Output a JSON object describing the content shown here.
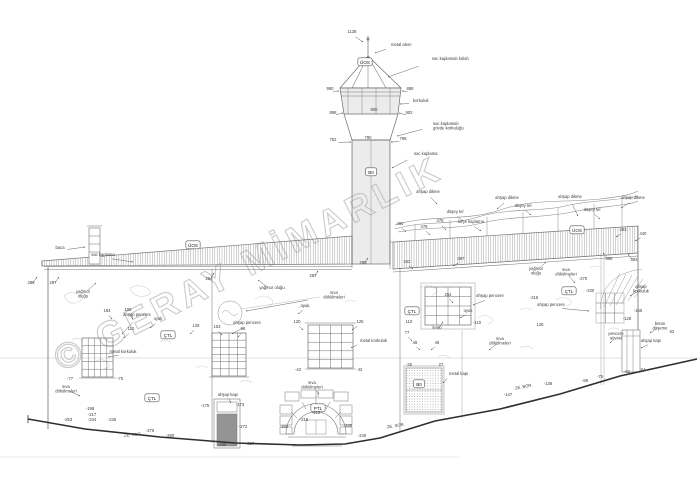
{
  "meta": {
    "watermark": "© GERAY MİMARLIK"
  },
  "colors": {
    "line": "#6e6e6e",
    "ground": "#2e2e2e",
    "watermark": "#cacaca",
    "roof_hatch": "#9d9d9d",
    "balcony_fill": "#ececec",
    "annotation_text": "#3c3c3c"
  },
  "drawing": {
    "tags": [
      {
        "x": 365,
        "y": 62,
        "t": "ÜOS"
      },
      {
        "x": 193,
        "y": 245,
        "t": "ÜOS"
      },
      {
        "x": 577,
        "y": 230,
        "t": "ÜOS"
      },
      {
        "x": 371,
        "y": 172,
        "t": "B0"
      },
      {
        "x": 419,
        "y": 384,
        "t": "B0"
      },
      {
        "x": 168,
        "y": 335,
        "t": "ÇTL"
      },
      {
        "x": 412,
        "y": 311,
        "t": "ÇTL"
      },
      {
        "x": 569,
        "y": 291,
        "t": "ÇTL"
      },
      {
        "x": 152,
        "y": 398,
        "t": "ÇTL"
      },
      {
        "x": 318,
        "y": 408,
        "t": "PTL"
      }
    ],
    "annotations": [
      {
        "x": 352,
        "y": 33,
        "t": "1138",
        "ax": 363,
        "ay": 42
      },
      {
        "x": 391,
        "y": 46,
        "t": "metal alem",
        "an": "start",
        "ax": 375,
        "ay": 53
      },
      {
        "x": 432,
        "y": 60,
        "t": "sac kaplamalı külah",
        "an": "start",
        "ax": 388,
        "ay": 77
      },
      {
        "x": 330,
        "y": 90,
        "t": "980",
        "ax": 339,
        "ay": 91
      },
      {
        "x": 410,
        "y": 90,
        "t": "888",
        "ax": 402,
        "ay": 91
      },
      {
        "x": 413,
        "y": 102,
        "t": "korkuluk",
        "an": "start",
        "ax": 400,
        "ay": 104
      },
      {
        "x": 333,
        "y": 114,
        "t": "898",
        "ax": 343,
        "ay": 113
      },
      {
        "x": 374,
        "y": 111,
        "t": "900"
      },
      {
        "x": 409,
        "y": 114,
        "t": "902",
        "ax": 399,
        "ay": 113
      },
      {
        "x": 333,
        "y": 141,
        "t": "752",
        "ax": 351,
        "ay": 142
      },
      {
        "x": 368,
        "y": 139,
        "t": "790"
      },
      {
        "x": 403,
        "y": 140,
        "t": "798",
        "ax": 391,
        "ay": 142
      },
      {
        "x": 433,
        "y": 125,
        "t": "sac kaplamalı",
        "t2": "gövde korkuluğu",
        "an": "start",
        "ax": 397,
        "ay": 136
      },
      {
        "x": 414,
        "y": 155,
        "t": "sac kaplama",
        "an": "start",
        "ax": 392,
        "ay": 168
      },
      {
        "x": 60,
        "y": 249,
        "t": "baca",
        "ax": 85,
        "ay": 247
      },
      {
        "x": 103,
        "y": 256,
        "t": "sac kaplama",
        "ax": 133,
        "ay": 262
      },
      {
        "x": 31,
        "y": 284,
        "t": "286",
        "ax": 37,
        "ay": 277
      },
      {
        "x": 53,
        "y": 284,
        "t": "287",
        "ax": 59,
        "ay": 277
      },
      {
        "x": 428,
        "y": 193,
        "t": "ahşap dikme",
        "ax": 437,
        "ay": 204
      },
      {
        "x": 507,
        "y": 199,
        "t": "ahşap dikme",
        "ax": 497,
        "ay": 209
      },
      {
        "x": 570,
        "y": 198,
        "t": "ahşap dikme",
        "ax": 578,
        "ay": 216
      },
      {
        "x": 633,
        "y": 199,
        "t": "ahşap dikme",
        "ax": 621,
        "ay": 208
      },
      {
        "x": 455,
        "y": 213,
        "t": "düşey tel",
        "ax": 463,
        "ay": 221
      },
      {
        "x": 523,
        "y": 207,
        "t": "düşey tel",
        "ax": 531,
        "ay": 215
      },
      {
        "x": 592,
        "y": 211,
        "t": "düşey tel",
        "ax": 600,
        "ay": 219
      },
      {
        "x": 471,
        "y": 223,
        "t": "keçe kaplama",
        "ax": 481,
        "ay": 231
      },
      {
        "x": 400,
        "y": 225,
        "t": "480",
        "ax": 406,
        "ay": 232
      },
      {
        "x": 424,
        "y": 228,
        "t": "479",
        "ax": 430,
        "ay": 235
      },
      {
        "x": 440,
        "y": 222,
        "t": "475",
        "ax": 446,
        "ay": 230
      },
      {
        "x": 623,
        "y": 231,
        "t": "483",
        "ax": 616,
        "ay": 237
      },
      {
        "x": 643,
        "y": 235,
        "t": "440",
        "ax": 635,
        "ay": 241
      },
      {
        "x": 609,
        "y": 260,
        "t": "398",
        "ax": 603,
        "ay": 253
      },
      {
        "x": 634,
        "y": 261,
        "t": "392",
        "ax": 628,
        "ay": 254
      },
      {
        "x": 461,
        "y": 260,
        "t": "387",
        "ax": 453,
        "ay": 266
      },
      {
        "x": 407,
        "y": 263,
        "t": "342",
        "ax": 413,
        "ay": 269
      },
      {
        "x": 209,
        "y": 280,
        "t": "284",
        "ax": 214,
        "ay": 273
      },
      {
        "x": 313,
        "y": 277,
        "t": "287",
        "ax": 318,
        "ay": 271
      },
      {
        "x": 363,
        "y": 264,
        "t": "298",
        "ax": 368,
        "ay": 258
      },
      {
        "x": 83,
        "y": 293,
        "t": "yağmur",
        "t2": "oluğu",
        "ax": 96,
        "ay": 283
      },
      {
        "x": 137,
        "y": 316,
        "t": "ahşap pencere",
        "ax": 122,
        "ay": 334
      },
      {
        "x": 158,
        "y": 320,
        "t": "oyuk",
        "ax": 150,
        "ay": 328
      },
      {
        "x": 107,
        "y": 312,
        "t": "184",
        "ax": 112,
        "ay": 319
      },
      {
        "x": 128,
        "y": 311,
        "t": "186",
        "ax": 133,
        "ay": 319
      },
      {
        "x": 131,
        "y": 330,
        "t": "110",
        "ax": 124,
        "ay": 338
      },
      {
        "x": 196,
        "y": 327,
        "t": "128",
        "ax": 190,
        "ay": 334
      },
      {
        "x": 123,
        "y": 353,
        "t": "metal korkuluk",
        "ax": 108,
        "ay": 357
      },
      {
        "x": 66,
        "y": 388,
        "t": "sıva",
        "t2": "dökülmeleri",
        "ax": 80,
        "ay": 396
      },
      {
        "x": 70,
        "y": 380,
        "t": "-77"
      },
      {
        "x": 120,
        "y": 380,
        "t": "-75"
      },
      {
        "x": 90,
        "y": 410,
        "t": "-198"
      },
      {
        "x": 92,
        "y": 416,
        "t": "-217"
      },
      {
        "x": 92,
        "y": 421,
        "t": "-234"
      },
      {
        "x": 68,
        "y": 421,
        "t": "-253"
      },
      {
        "x": 112,
        "y": 421,
        "t": "-236"
      },
      {
        "x": 150,
        "y": 432,
        "t": "-276"
      },
      {
        "x": 170,
        "y": 437,
        "t": "-280"
      },
      {
        "x": 247,
        "y": 324,
        "t": "ahşap pencere",
        "ax": 232,
        "ay": 334
      },
      {
        "x": 217,
        "y": 328,
        "t": "153",
        "ax": 222,
        "ay": 335
      },
      {
        "x": 243,
        "y": 330,
        "t": "98",
        "ax": 238,
        "ay": 337
      },
      {
        "x": 272,
        "y": 289,
        "t": "yağmur oluğu",
        "ax": 258,
        "ay": 280
      },
      {
        "x": 334,
        "y": 294,
        "t": "sıva",
        "t2": "dökülmeleri",
        "ax": 246,
        "ay": 311
      },
      {
        "x": 305,
        "y": 307,
        "t": "oyuk",
        "ax": 298,
        "ay": 314
      },
      {
        "x": 297,
        "y": 323,
        "t": "120",
        "ax": 303,
        "ay": 330
      },
      {
        "x": 360,
        "y": 323,
        "t": "125",
        "ax": 352,
        "ay": 330
      },
      {
        "x": 360,
        "y": 342,
        "t": "metal korkuluk",
        "an": "start",
        "ax": 351,
        "ay": 348
      },
      {
        "x": 298,
        "y": 371,
        "t": "-42"
      },
      {
        "x": 360,
        "y": 371,
        "t": "42"
      },
      {
        "x": 437,
        "y": 329,
        "t": "lento",
        "ax": 443,
        "ay": 322
      },
      {
        "x": 409,
        "y": 323,
        "t": "110"
      },
      {
        "x": 477,
        "y": 324,
        "t": "-110"
      },
      {
        "x": 448,
        "y": 296,
        "t": "254",
        "ax": 453,
        "ay": 303
      },
      {
        "x": 490,
        "y": 297,
        "t": "ahşap pencere",
        "ax": 473,
        "ay": 305
      },
      {
        "x": 468,
        "y": 312,
        "t": "oyuk",
        "ax": 460,
        "ay": 318
      },
      {
        "x": 407,
        "y": 334,
        "t": "77",
        "ax": 412,
        "ay": 341
      },
      {
        "x": 415,
        "y": 344,
        "t": "48",
        "ax": 420,
        "ay": 350
      },
      {
        "x": 437,
        "y": 344,
        "t": "46",
        "ax": 431,
        "ay": 350
      },
      {
        "x": 409,
        "y": 366,
        "t": "-26"
      },
      {
        "x": 441,
        "y": 366,
        "t": "27"
      },
      {
        "x": 449,
        "y": 375,
        "t": "metal kapı",
        "an": "start",
        "ax": 443,
        "ay": 383
      },
      {
        "x": 500,
        "y": 340,
        "t": "sıva",
        "t2": "dökülmeleri",
        "ax": 489,
        "ay": 350
      },
      {
        "x": 312,
        "y": 384,
        "t": "sıva",
        "t2": "dökülmeleri",
        "ax": 319,
        "ay": 394
      },
      {
        "x": 316,
        "y": 414,
        "t": "-212"
      },
      {
        "x": 304,
        "y": 421,
        "t": "-215"
      },
      {
        "x": 284,
        "y": 428,
        "t": "-232"
      },
      {
        "x": 348,
        "y": 427,
        "t": "-235"
      },
      {
        "x": 362,
        "y": 437,
        "t": "-240"
      },
      {
        "x": 228,
        "y": 396,
        "t": "ahşap kapı",
        "ax": 231,
        "ay": 403
      },
      {
        "x": 205,
        "y": 407,
        "t": "-175"
      },
      {
        "x": 240,
        "y": 406,
        "t": "-173"
      },
      {
        "x": 222,
        "y": 446,
        "t": "-240"
      },
      {
        "x": 243,
        "y": 428,
        "t": "-272"
      },
      {
        "x": 250,
        "y": 445,
        "t": "-227"
      },
      {
        "x": 536,
        "y": 270,
        "t": "yağmur",
        "t2": "oluğu",
        "ax": 546,
        "ay": 262
      },
      {
        "x": 566,
        "y": 271,
        "t": "sıva",
        "t2": "dökülmeleri",
        "ax": 575,
        "ay": 283
      },
      {
        "x": 583,
        "y": 280,
        "t": "-270"
      },
      {
        "x": 590,
        "y": 292,
        "t": "-230"
      },
      {
        "x": 534,
        "y": 299,
        "t": "-215"
      },
      {
        "x": 551,
        "y": 306,
        "t": "ahşap pencere",
        "ax": 589,
        "ay": 311
      },
      {
        "x": 540,
        "y": 326,
        "t": "128"
      },
      {
        "x": 641,
        "y": 288,
        "t": "ahşap",
        "t2": "korkuluk",
        "ax": 630,
        "ay": 296
      },
      {
        "x": 638,
        "y": 312,
        "t": "-155"
      },
      {
        "x": 627,
        "y": 320,
        "t": "-128"
      },
      {
        "x": 660,
        "y": 325,
        "t": "beton",
        "t2": "döşeme",
        "ax": 650,
        "ay": 333
      },
      {
        "x": 672,
        "y": 333,
        "t": "62"
      },
      {
        "x": 616,
        "y": 335,
        "t": "pencere",
        "t2": "sövesi",
        "ax": 610,
        "ay": 343
      },
      {
        "x": 651,
        "y": 342,
        "t": "ahşap kapı",
        "ax": 641,
        "ay": 348
      },
      {
        "x": 600,
        "y": 378,
        "t": "-75"
      },
      {
        "x": 627,
        "y": 373,
        "t": "-62"
      },
      {
        "x": 643,
        "y": 371,
        "t": "64"
      },
      {
        "x": 585,
        "y": 382,
        "t": "-88"
      },
      {
        "x": 548,
        "y": 385,
        "t": "-138"
      },
      {
        "x": 508,
        "y": 396,
        "t": "-147"
      },
      {
        "x": 133,
        "y": 436,
        "t": "ZE. SOR.",
        "r": -4
      },
      {
        "x": 396,
        "y": 427,
        "t": "ZE. SOR.",
        "r": -9
      },
      {
        "x": 524,
        "y": 388,
        "t": "ZE. BÖR.",
        "r": -11
      }
    ]
  }
}
